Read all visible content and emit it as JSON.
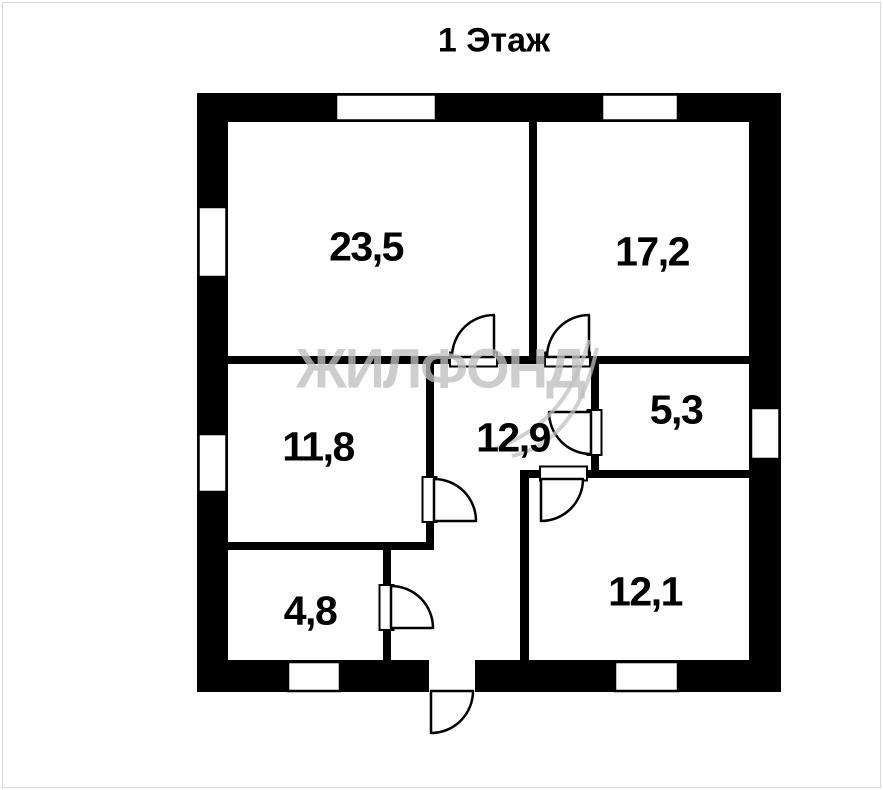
{
  "title": "1 Этаж",
  "watermark": "ЖИЛФОНД",
  "rooms": [
    {
      "name": "living-room",
      "area": "23,5"
    },
    {
      "name": "bedroom-1",
      "area": "17,2"
    },
    {
      "name": "bedroom-2",
      "area": "11,8"
    },
    {
      "name": "hallway",
      "area": "12,9"
    },
    {
      "name": "bathroom",
      "area": "5,3"
    },
    {
      "name": "storage",
      "area": "4,8"
    },
    {
      "name": "kitchen",
      "area": "12,1"
    }
  ],
  "colors": {
    "wall": "#000000",
    "background": "#ffffff",
    "watermark": "#c0c0c0",
    "page_border": "#d9d9d9"
  }
}
